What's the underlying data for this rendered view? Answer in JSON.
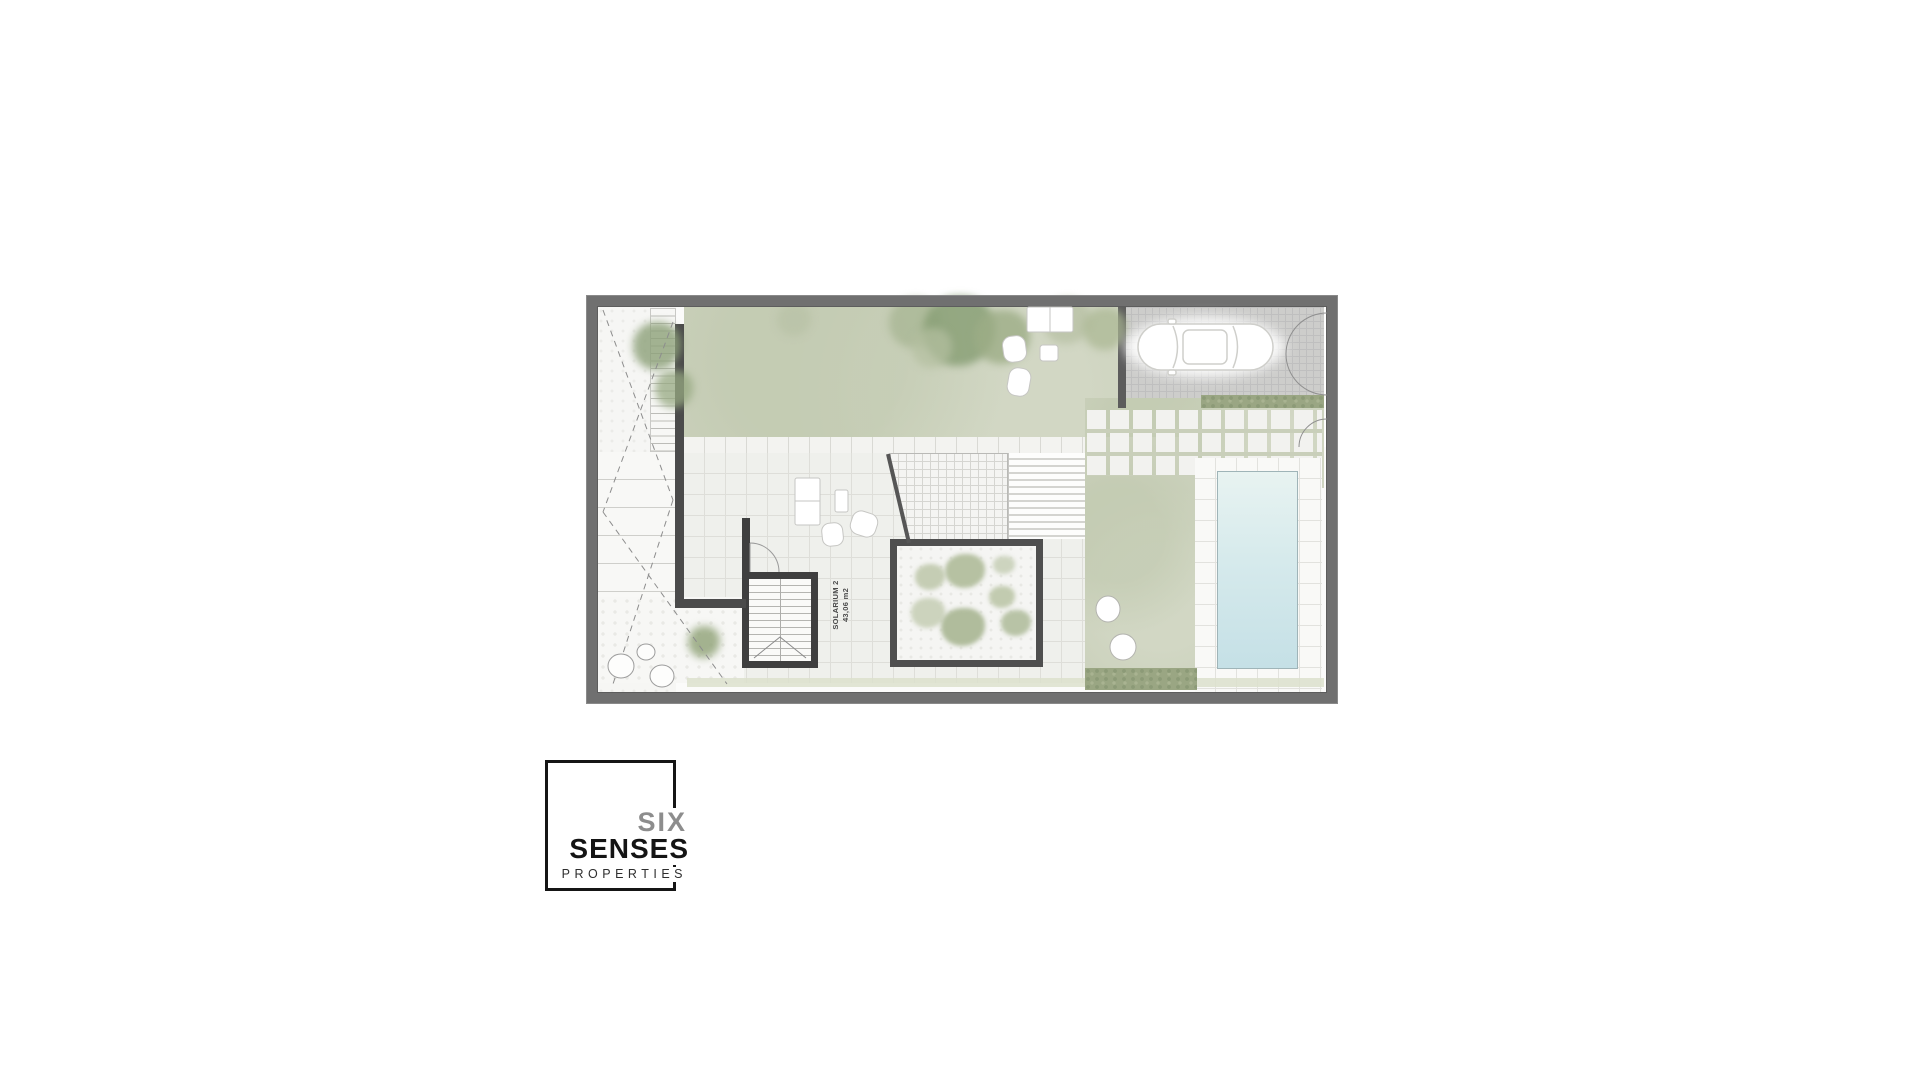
{
  "floor_plan": {
    "room_label": {
      "name": "SOLARIUM 2",
      "area": "43,06 m2"
    }
  },
  "logo": {
    "word1": "SIX",
    "word2": "SENSES",
    "word3": "PROPERTIES"
  },
  "colors": {
    "background": "#ffffff",
    "outer_wall": "#707070",
    "inner_wall": "#4b4b4b",
    "lawn": "#cbd1bc",
    "hedge": "#9aa683",
    "terrace_tile": "#eff0ec",
    "parking_cobble": "#cdcdcb",
    "pool_water_top": "#e8f3f1",
    "pool_water_bottom": "#c5e0e6",
    "label_text": "#4a4a4a",
    "logo_black": "#151515",
    "logo_gray": "#8d8d8d"
  }
}
